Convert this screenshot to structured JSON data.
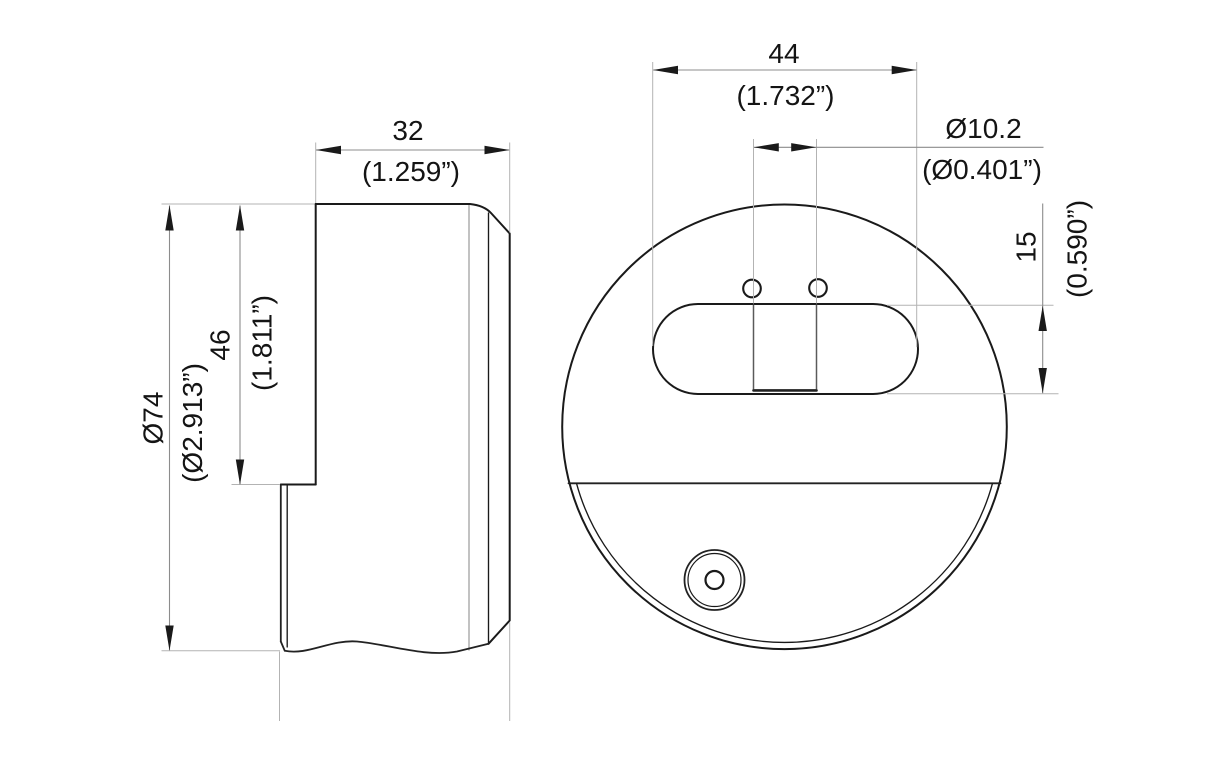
{
  "drawing": {
    "type": "engineering-dimension-drawing",
    "background_color": "#ffffff",
    "line_color": "#1a1a1a",
    "dimension_line_color": "#8c8c8c",
    "extension_line_color": "#b3b3b3",
    "side_view": {
      "thickness_dim": {
        "value": "32",
        "alt": "(1.259”)"
      },
      "diameter_dim": {
        "value": "Ø74",
        "alt": "(Ø2.913”)"
      },
      "upper_depth_dim": {
        "value": "46",
        "alt": "(1.811”)"
      }
    },
    "front_view": {
      "slot_length_dim": {
        "value": "44",
        "alt": "(1.732”)"
      },
      "hole_diameter_dim": {
        "value": "Ø10.2",
        "alt": "(Ø0.401”)"
      },
      "slot_height_dim": {
        "value": "15",
        "alt": "(0.590”)"
      }
    }
  }
}
